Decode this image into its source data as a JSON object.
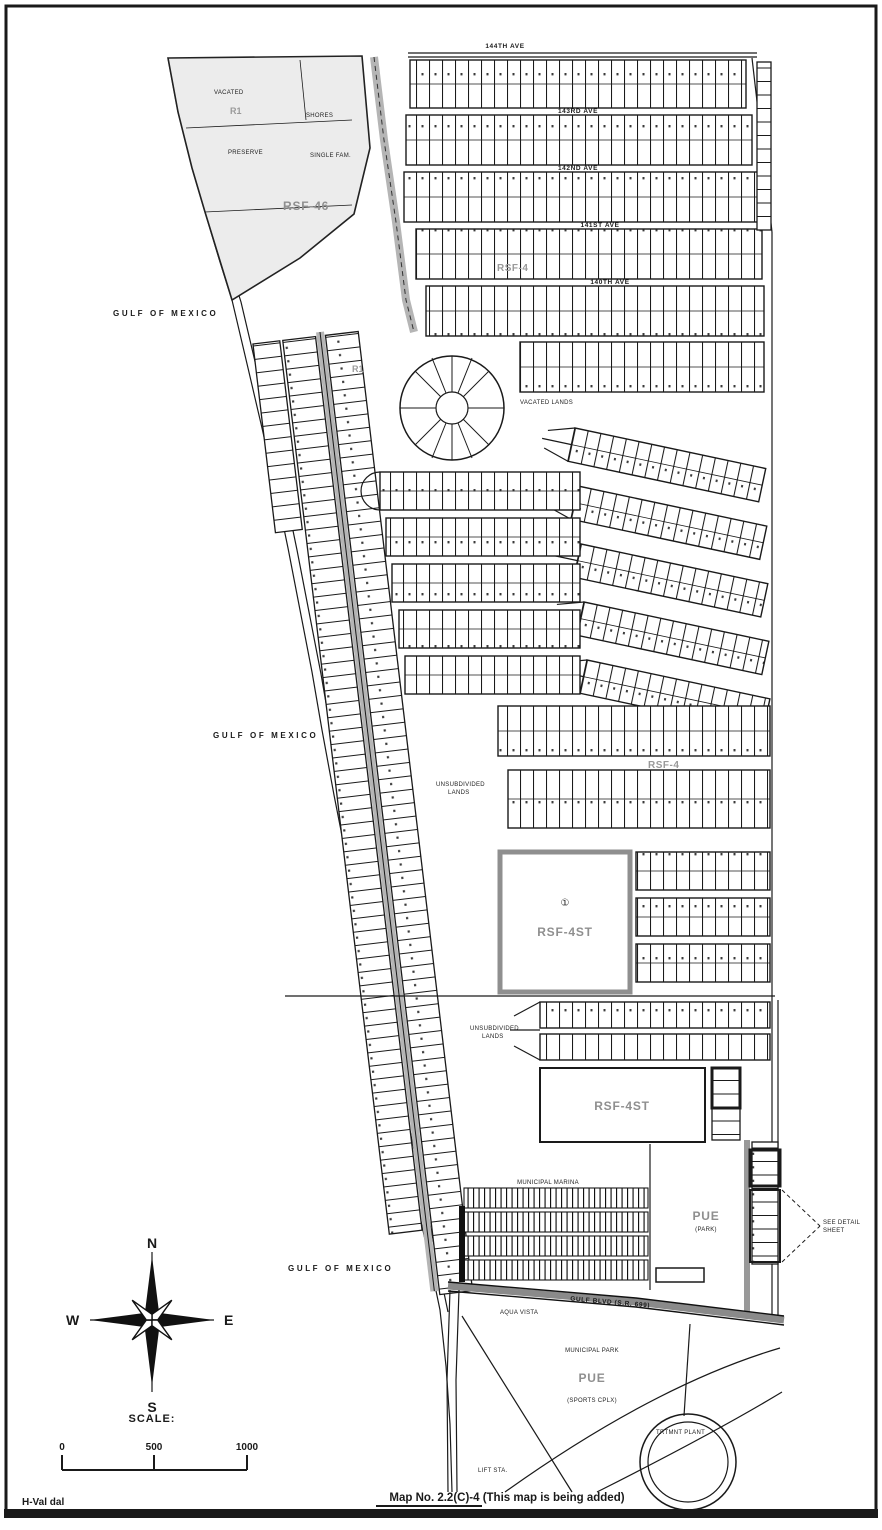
{
  "doc": {
    "caption": "Map No. 2.2(C)-4 (This map is being added)",
    "footer_code": "H-Val dal"
  },
  "compass": {
    "n": "N",
    "e": "E",
    "s": "S",
    "w": "W"
  },
  "scalebar": {
    "label": "SCALE:",
    "t0": "0",
    "t500": "500",
    "t1000": "1000"
  },
  "water": {
    "upper": "GULF OF MEXICO",
    "middle": "GULF OF MEXICO",
    "lower": "GULF OF MEXICO"
  },
  "zones": {
    "rsf46": "RSF-46",
    "r1_top": "R1",
    "r1_mid": "R1",
    "rsf4_upper": "RSF-4",
    "rsf4_lower": "RSF-4",
    "rsf4st_big": "RSF-4ST",
    "rsf4st_south": "RSF-4ST",
    "pue_east": "PUE",
    "pue_east_sub": "(PARK)",
    "pue_south": "PUE",
    "marker_one": "①"
  },
  "streets": {
    "top": "144TH AVE",
    "row1": "143RD AVE",
    "row2": "142ND AVE",
    "row3": "141ST AVE",
    "row4": "140TH AVE",
    "gulf_blvd": "GULF BLVD (S.R. 699)"
  },
  "areas": {
    "vacated": "VACATED",
    "preserve": "PRESERVE",
    "shores": "SHORES",
    "single_fam": "SINGLE FAM.",
    "vacated_lands": "VACATED LANDS",
    "unsub_a1": "UNSUBDIVIDED",
    "unsub_a2": "LANDS",
    "unsub_b1": "UNSUBDIVIDED",
    "unsub_b2": "LANDS",
    "marina": "MUNICIPAL MARINA",
    "muni_park": "MUNICIPAL PARK",
    "sports": "(SPORTS CPLX)",
    "plant": "TRTMNT PLANT",
    "aqua": "AQUA VISTA",
    "lift": "LIFT STA."
  },
  "callout": {
    "l1": "SEE DETAIL",
    "l2": "SHEET"
  }
}
